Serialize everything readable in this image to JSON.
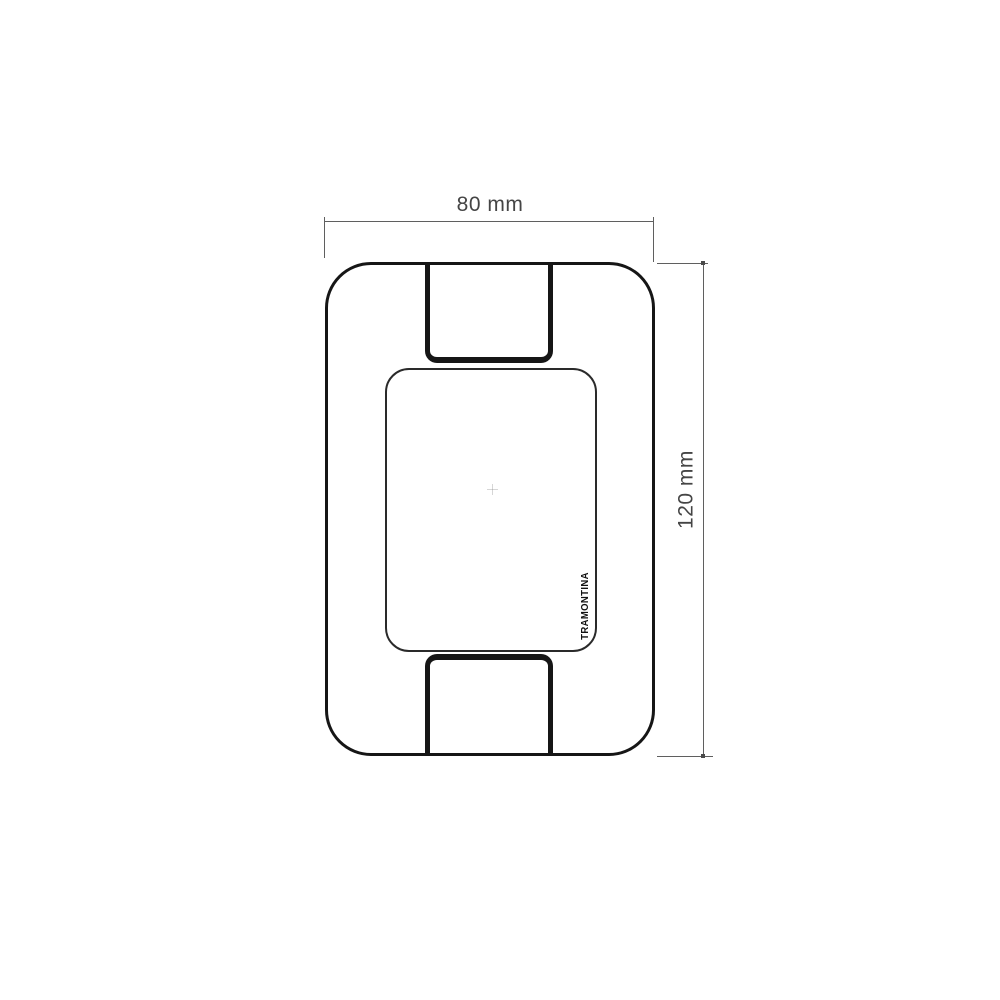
{
  "drawing": {
    "brand_label": "TRAMONTINA",
    "width_dimension": {
      "label": "80 mm",
      "value_mm": 80
    },
    "height_dimension": {
      "label": "120 mm",
      "value_mm": 120
    },
    "colors": {
      "background": "#ffffff",
      "plate_outline": "#161616",
      "dimension_line": "#5f5f5f",
      "dimension_text": "#454545"
    }
  }
}
